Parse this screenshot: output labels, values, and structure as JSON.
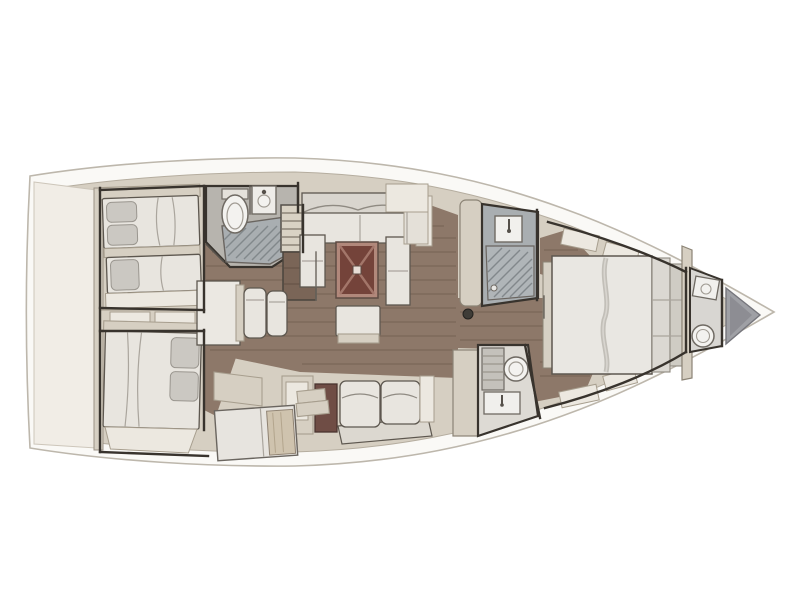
{
  "title": "Sailing yacht interior layout floor plan, top view with bow pointing right",
  "palette": {
    "page_bg": "#ffffff",
    "hull_white": "#faf9f6",
    "hull_stroke": "#bdb7ac",
    "deck_beige": "#d6cfc2",
    "deck_light": "#ece8e0",
    "beige_stroke": "#a79e8e",
    "cream_panel": "#f1ede6",
    "furniture_white": "#e8e5df",
    "furniture_stroke": "#5d574f",
    "fixture_white": "#f3f2ef",
    "fixture_stroke": "#6f6a63",
    "wall_dark": "#38332d",
    "wall_mid": "#6a655e",
    "wood_floor": "#8d7869",
    "wood_dark": "#7a6557",
    "wood_line": "#5f4d40",
    "head_floor_gray": "#b7b4ae",
    "shower_gray": "#a9aeb1",
    "grate_line": "#82888b",
    "table_red": "#74433a",
    "table_red_frame": "#b1887b",
    "table_red_cross": "#a3766a",
    "locker_brown": "#6f4d45",
    "anchor_gray": "#9fa0a5",
    "anchor_gray_dark": "#8d8d93",
    "pillow_gray": "#cbc8c2",
    "wood_door": "#cfc3ae"
  },
  "areas": {
    "hull": {
      "label": "Hull outline, bow to the right"
    },
    "stern_platform": {
      "label": "Stern transom and swim platform"
    },
    "aft_cabin_port": {
      "label": "Aft port cabin with double berth"
    },
    "aft_cabin_starboard": {
      "label": "Aft starboard cabin with double berth"
    },
    "aft_head": {
      "label": "Aft head with toilet, washbasin and shower grating"
    },
    "companionway": {
      "label": "Companionway steps down from cockpit"
    },
    "salon": {
      "label": "Salon with settees and folding table with red top"
    },
    "dinette": {
      "label": "Salon dining table with two chairs"
    },
    "storage": {
      "label": "Lockers, sideboard and galley units"
    },
    "forward_shower": {
      "label": "Forward shower compartment with grating"
    },
    "forward_head": {
      "label": "Forward head with toilet, vanity and washbasin"
    },
    "owner_cabin": {
      "label": "Forward owner cabin with island double bed"
    },
    "bow_head": {
      "label": "Bow head with toilet and washbasin"
    },
    "anchor_locker": {
      "label": "Anchor locker in the bow"
    }
  }
}
